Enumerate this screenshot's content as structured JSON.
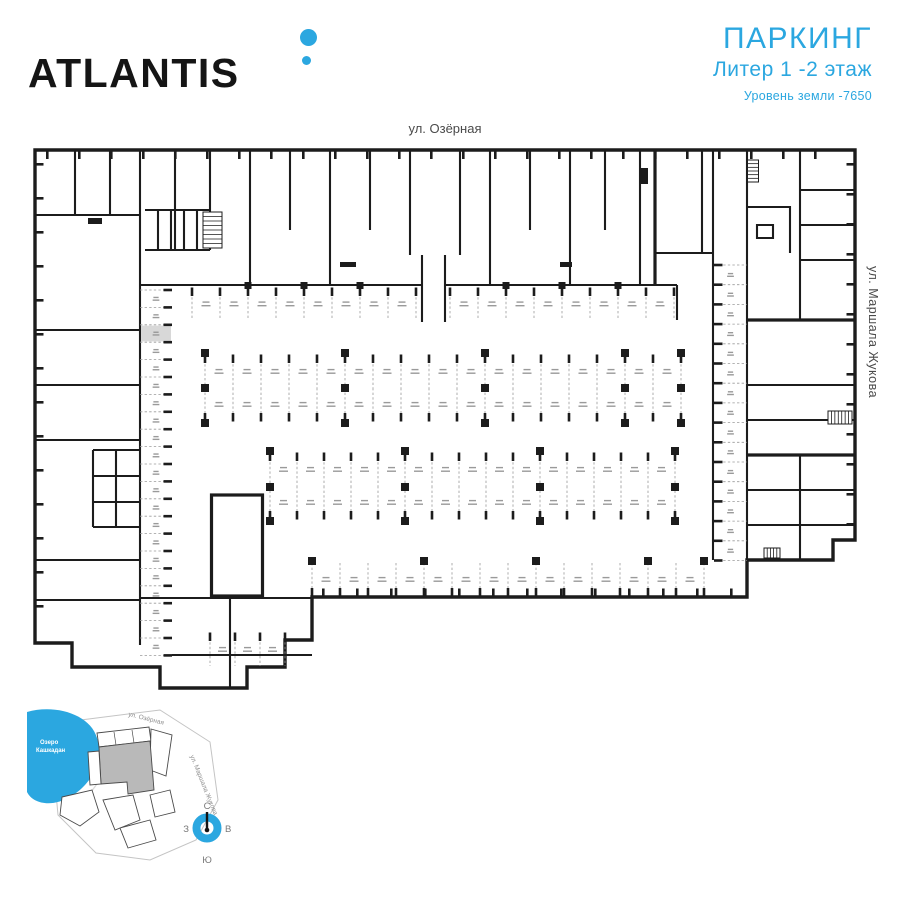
{
  "header": {
    "logo_text": "ATLANTIS",
    "title": "ПАРКИНГ",
    "subtitle": "Литер 1 -2 этаж",
    "note": "Уровень земли -7650"
  },
  "streets": {
    "top": "ул. Озёрная",
    "right": "ул. Маршала Жукова"
  },
  "minimap": {
    "lake_lines": [
      "Озеро",
      "Кашкадан"
    ],
    "street_top": "ул. Озёрная",
    "street_right": "ул. Маршала Жукова"
  },
  "compass": {
    "north": "С",
    "south": "Ю",
    "west": "З",
    "east": "В"
  },
  "colors": {
    "accent": "#2BA7E0",
    "walls": "#1C1C1C",
    "stall_highlight": "#D8D8D8",
    "muted_text": "#4A4A4A",
    "stall_line": "#9A9A9A"
  }
}
